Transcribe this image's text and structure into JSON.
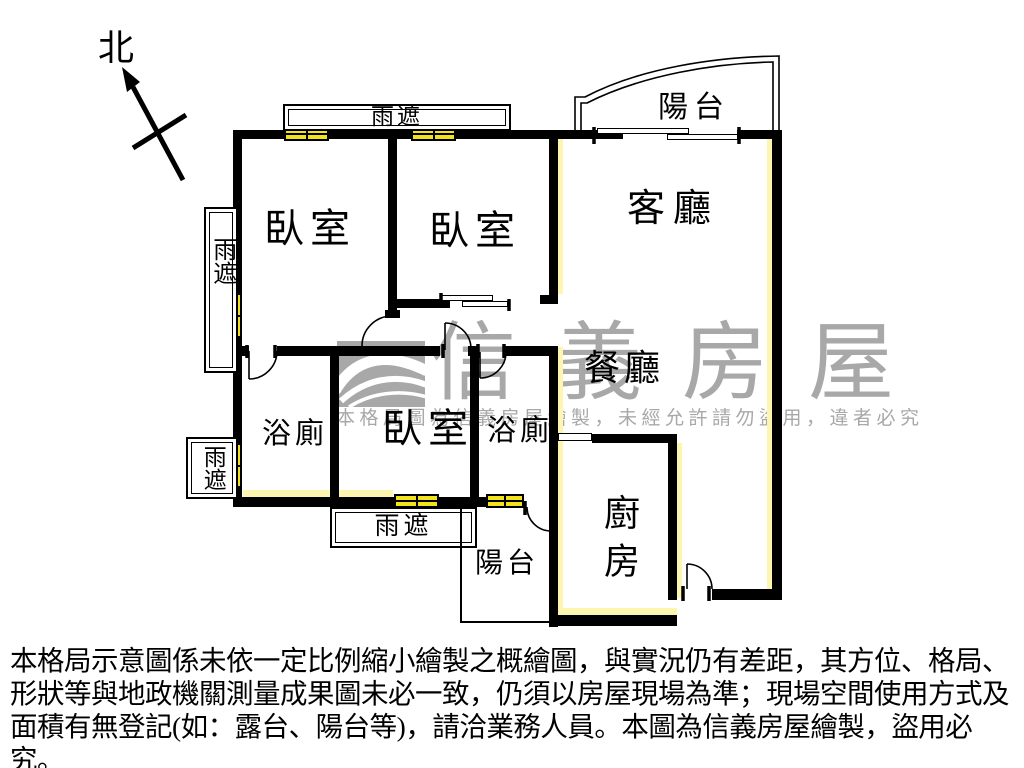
{
  "compass": {
    "north_label": "北"
  },
  "rooms": {
    "bedroom1": "臥室",
    "bedroom2": "臥室",
    "bedroom3": "臥室",
    "living_room": "客廳",
    "dining_room": "餐廳",
    "bathroom1": "浴廁",
    "bathroom2": "浴廁",
    "kitchen": "廚房",
    "balcony_top": "陽台",
    "balcony_bottom": "陽台"
  },
  "canopies": {
    "top": "雨遮",
    "left_upper": "雨遮",
    "left_lower": "雨遮",
    "bottom": "雨遮"
  },
  "watermark": {
    "brand": "信義房屋",
    "notice": "本格局圖為信義房屋繪製，未經允許請勿盜用，違者必究"
  },
  "disclaimer": {
    "line1": "本格局示意圖係未依一定比例縮小繪製之概繪圖，與實況仍有差距，其方位、格局、",
    "line2": "形狀等與地政機關測量成果圖未必一致，仍須以房屋現場為準；現場空間使用方式及",
    "line3": "面積有無登記(如：露台、陽台等)，請洽業務人員。本圖為信義房屋繪製，盜用必究。"
  },
  "colors": {
    "wall": "#000000",
    "window": "#f3e31c",
    "highlight": "#fcf6b1",
    "watermark": "#a8a8a8"
  }
}
